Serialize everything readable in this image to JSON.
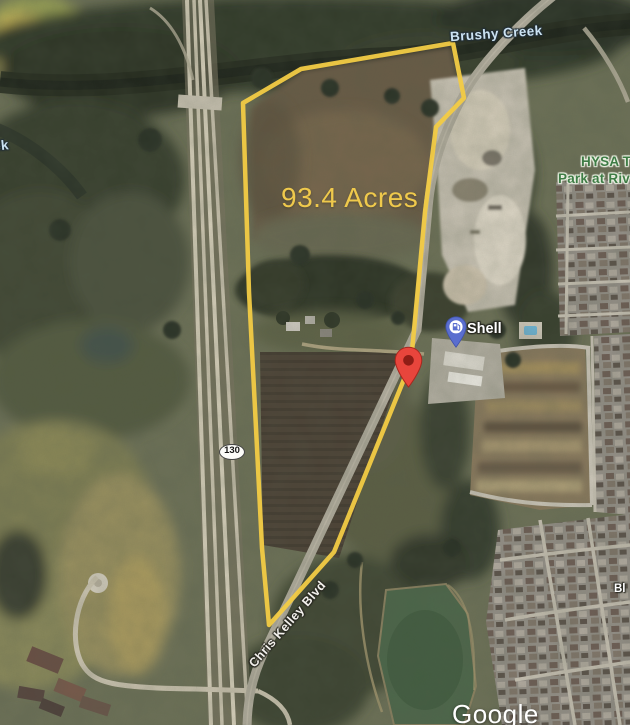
{
  "map": {
    "view": "satellite",
    "watermark": "Google",
    "labels": {
      "creek": "Brushy Creek",
      "creek_partial": "ek",
      "park_name_line1": "HYSA T",
      "park_name_line2": "Park at Riv",
      "road_name": "Chris Kelley Blvd",
      "street_partial": "Bl",
      "highway_shield": "130"
    },
    "parcel": {
      "acreage": "93.4 Acres",
      "outline_color": "#F2CB45"
    },
    "poi": {
      "shell": {
        "name": "Shell",
        "pin_color": "#5A6ECF"
      }
    },
    "marker": {
      "type": "dropped-pin",
      "color": "#E8453C"
    },
    "colors": {
      "water_label": "#CBE2F2",
      "park_label": "#3E7C45",
      "pond": "#4D684B",
      "highway_lane": "#D6CFBA"
    }
  }
}
